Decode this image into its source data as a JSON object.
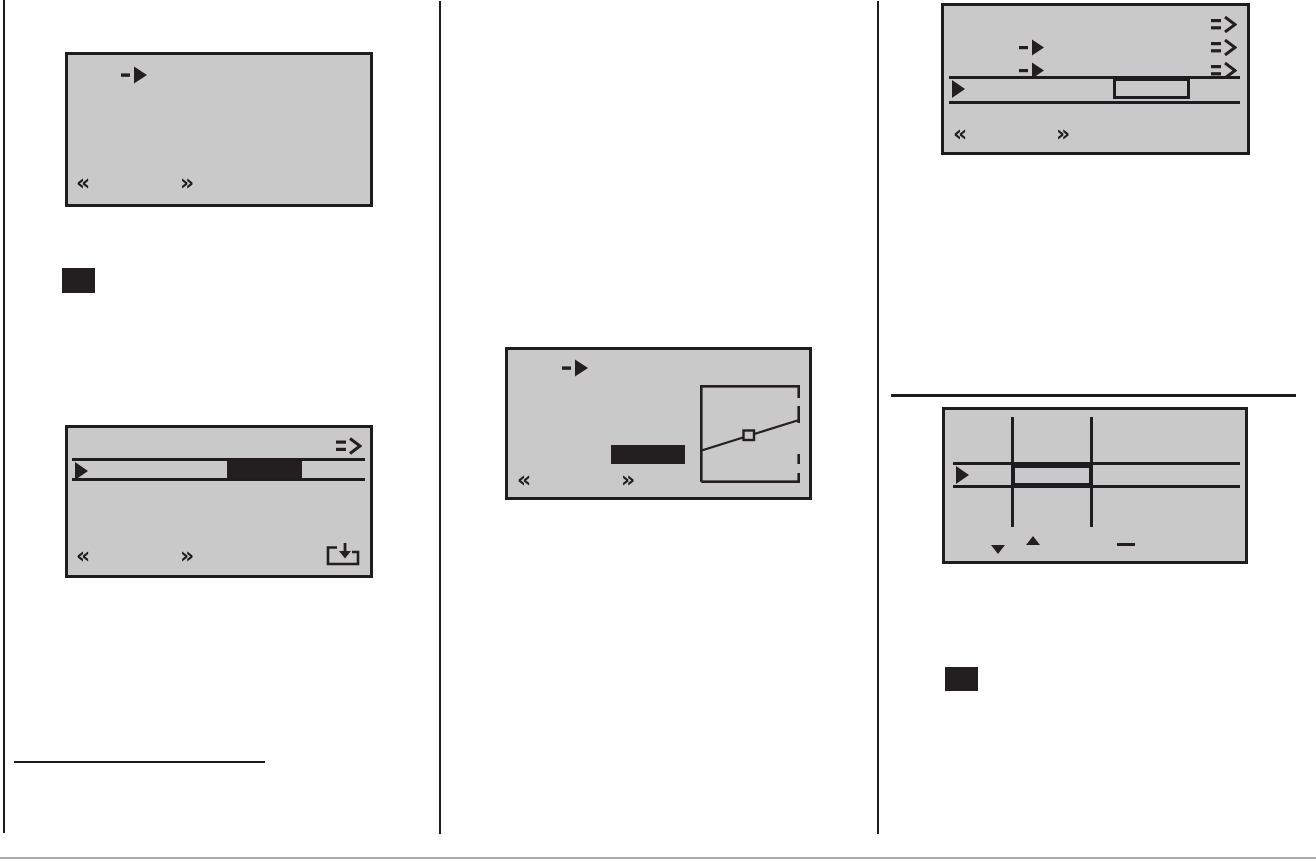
{
  "document": {
    "kind": "instruction manual page with device LCD screen illustrations",
    "columns": 3,
    "background": "#ffffff"
  },
  "colors": {
    "screen_background": "#c8c9c8",
    "ink": "#231f20",
    "screen_border": "#1d1d1f",
    "column_divider": "#1c1c1c",
    "page_bottom_rule": "#ababab"
  },
  "glyphs": {
    "prev": "«",
    "next": "»"
  },
  "screens": {
    "screen1": {
      "description": "empty menu screen",
      "icons": [
        "menu-arrow",
        "prev-chevron",
        "next-chevron"
      ]
    },
    "screen2": {
      "description": "setting track with filled selection cell",
      "icons": [
        "shift-arrow",
        "cursor-triangle",
        "prev-chevron",
        "next-chevron",
        "save-icon"
      ],
      "track": {
        "selection": "filled-black-cell",
        "cell_position": "center-right"
      }
    },
    "screen3": {
      "description": "curve adjustment screen with diagonal graph and highlighted value",
      "icons": [
        "menu-arrow",
        "prev-chevron",
        "next-chevron"
      ],
      "graph": {
        "line": "diagonal rising left-to-right",
        "marker": "small square at midpoint",
        "right_edge": "dashed"
      },
      "value_box": "filled-black-rectangle"
    },
    "screen4": {
      "description": "three-row menu list with track and outlined selection cell",
      "icons": [
        "shift-arrow",
        "shift-arrow",
        "shift-arrow",
        "menu-arrow",
        "menu-arrow",
        "cursor-triangle",
        "prev-chevron",
        "next-chevron"
      ],
      "track": {
        "selection": "outlined-cell",
        "cell_position": "center-right"
      }
    },
    "screen5": {
      "description": "width adjustment screen with two guide lines and thick outlined cell",
      "icons": [
        "cursor-triangle",
        "down-triangle",
        "up-triangle",
        "minus-dash"
      ],
      "guides": 2,
      "track": {
        "selection": "thick-outlined-cell",
        "cell_position": "between guides"
      }
    }
  },
  "standalone_marks": [
    "black-square-left",
    "black-square-right",
    "left-column-rule",
    "right-column-rule",
    "page-bottom-rule"
  ]
}
